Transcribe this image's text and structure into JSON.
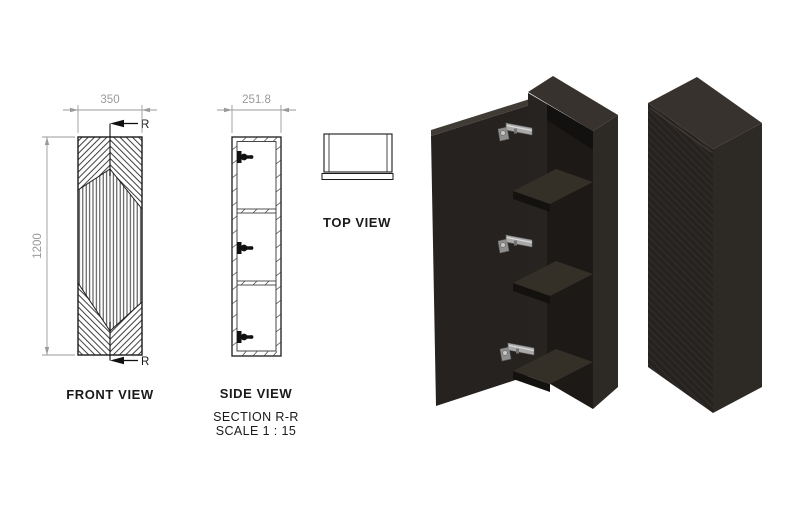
{
  "drawing": {
    "front_view": {
      "label": "FRONT VIEW",
      "width_dim": "350",
      "height_dim": "1200",
      "section_letter": "R"
    },
    "side_view": {
      "label": "SIDE VIEW",
      "depth_dim": "251.8",
      "section_title": "SECTION R-R",
      "scale_note": "SCALE 1 : 15"
    },
    "top_view": {
      "label": "TOP VIEW"
    }
  },
  "colors": {
    "line_black": "#1a1a1a",
    "dim_gray": "#9a9a9a",
    "cab_top": "#37322d",
    "cab_front": "#262220",
    "cab_side": "#2d2925",
    "cab_interior": "#1c1917",
    "cab_shelf": "#343028",
    "hinge_metal": "#a9a9a9"
  }
}
